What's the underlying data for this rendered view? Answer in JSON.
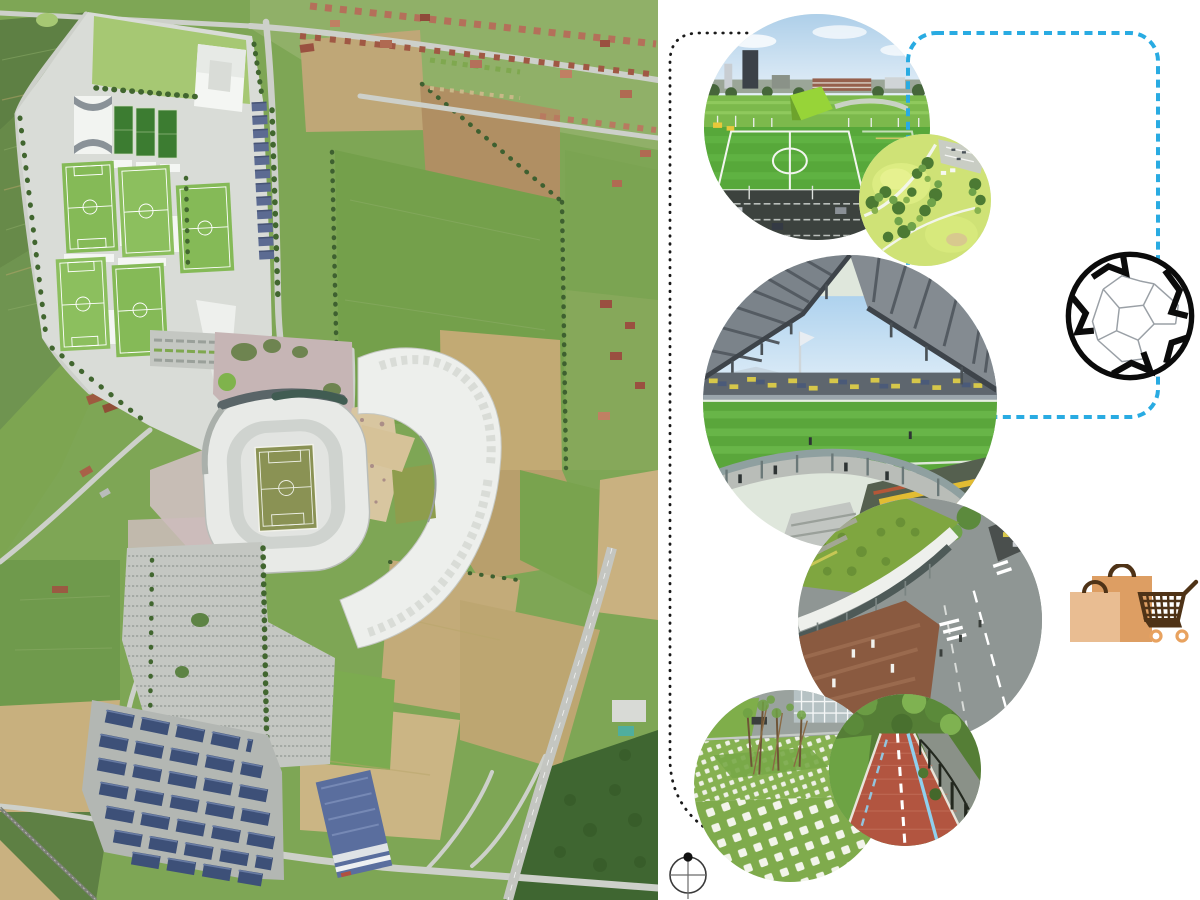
{
  "page": {
    "kind": "stadium-masterplan-presentation-board",
    "background": "#ffffff"
  },
  "map": {
    "name": "aerial-masterplan-rendering",
    "description_names": [
      "training-pitches",
      "indoor-arena",
      "service-barns",
      "stadium-bowl",
      "stadium-pitch",
      "esplanade",
      "event-plaza",
      "retail-arc-building",
      "visitor-parking",
      "solar-carports",
      "warehouse",
      "roundabout",
      "motorway",
      "railway",
      "farm-fields",
      "suburb-houses",
      "forest"
    ],
    "palette": {
      "site_platform": "#d9dcd7",
      "lawn": "#a6c873",
      "pitch_light": "#85ba57",
      "pitch_dark": "#3c7c31",
      "stadium_shell": "#e8eae7",
      "stadium_pitch": "#8a9254",
      "esplanade_pink": "#c6b5b5",
      "plaza_tan": "#d8c6a0",
      "retail_white": "#edefec",
      "barn_blue": "#5c6b92",
      "solar_blue": "#3d5078",
      "warehouse_blue": "#5a6e9e",
      "road": "#cdd0ca",
      "field_green": "#74a04b",
      "field_tan": "#c2aa74",
      "forest": "#3f6631"
    }
  },
  "callouts": [
    {
      "id": "training-fields-photo",
      "shape": "circle"
    },
    {
      "id": "rooftop-park-photo",
      "shape": "circle"
    },
    {
      "id": "stadium-interior-photo",
      "shape": "circle"
    },
    {
      "id": "retail-street-photo",
      "shape": "circle"
    },
    {
      "id": "grass-paver-photo",
      "shape": "circle"
    },
    {
      "id": "cycle-path-photo",
      "shape": "circle"
    }
  ],
  "connectors": {
    "dotted_path": {
      "name": "black-dotted-connector",
      "color": "#1a1a1a"
    },
    "frame": {
      "name": "blue-dashed-rounded-frame",
      "color": "#29abe2"
    }
  },
  "icons": {
    "soccer_ball": {
      "name": "soccer-ball-icon",
      "outline": "#0b0b0b",
      "seam": "#9aa0a6"
    },
    "shopping": {
      "name": "shopping-icon",
      "bag_back": "#dd9e63",
      "bag_front": "#e9bd92",
      "handles_cart": "#4f3317",
      "wheels": "#e8a25f"
    },
    "compass": {
      "name": "compass-north-icon",
      "ring": "#3a3a3a",
      "cross": "#6b6b6b",
      "dot": "#111111"
    }
  }
}
